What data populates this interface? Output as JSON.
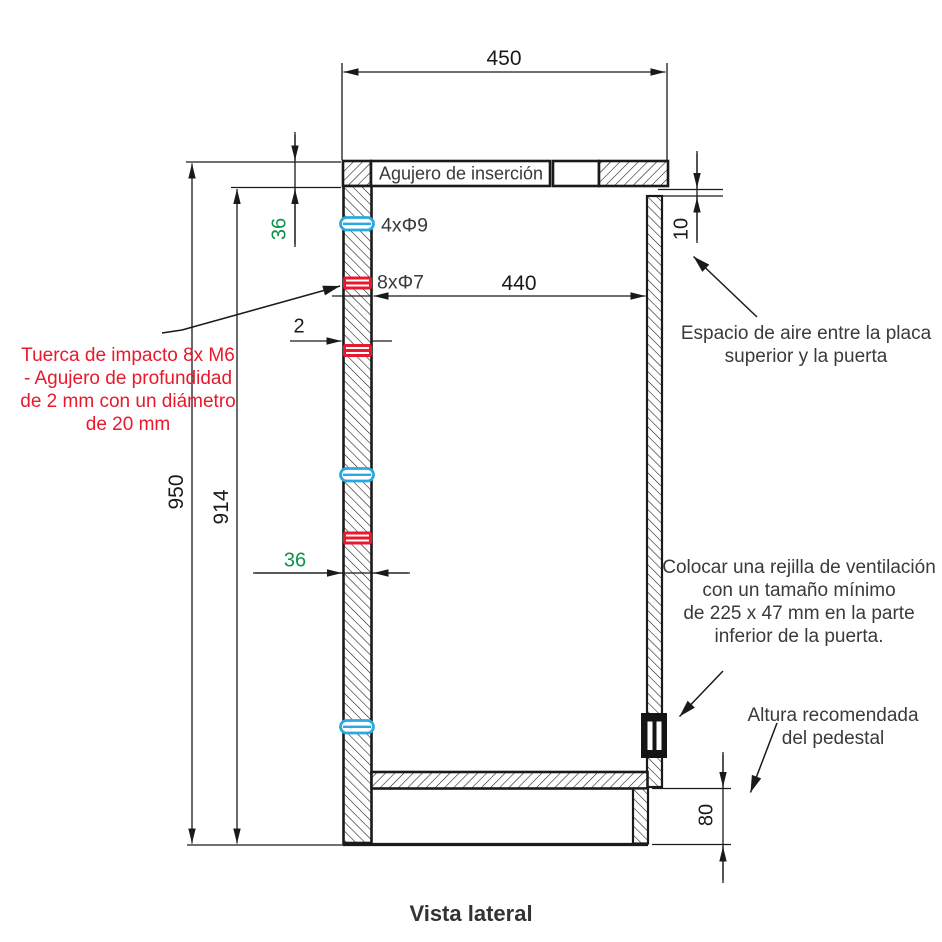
{
  "title": "Vista lateral",
  "colors": {
    "line": "#1a1a1a",
    "red": "#e8192d",
    "cyan": "#29a9e1",
    "green": "#0b9447"
  },
  "dimensions": {
    "top_width": "450",
    "inner_width": "440",
    "overall_height": "950",
    "inner_height": "914",
    "top_plate_thickness": "36",
    "wall_thickness": "36",
    "hole_depth": "2",
    "air_gap": "10",
    "pedestal_height": "80"
  },
  "labels": {
    "insertion_hole": "Agujero de inserción",
    "holes_d9": "4xΦ9",
    "holes_d7": "8xΦ7",
    "impact_nut_note": [
      "Tuerca de impacto 8x M6",
      "- Agujero de profundidad",
      "de 2 mm con un diámetro",
      "de 20 mm"
    ],
    "air_gap_note": [
      "Espacio de aire entre la placa",
      "superior y la puerta"
    ],
    "vent_note": [
      "Colocar una rejilla de ventilación",
      "con un tamaño mínimo",
      "de 225 x 47 mm en la parte",
      "inferior de la puerta."
    ],
    "pedestal_note": [
      "Altura recomendada",
      "del pedestal"
    ]
  }
}
